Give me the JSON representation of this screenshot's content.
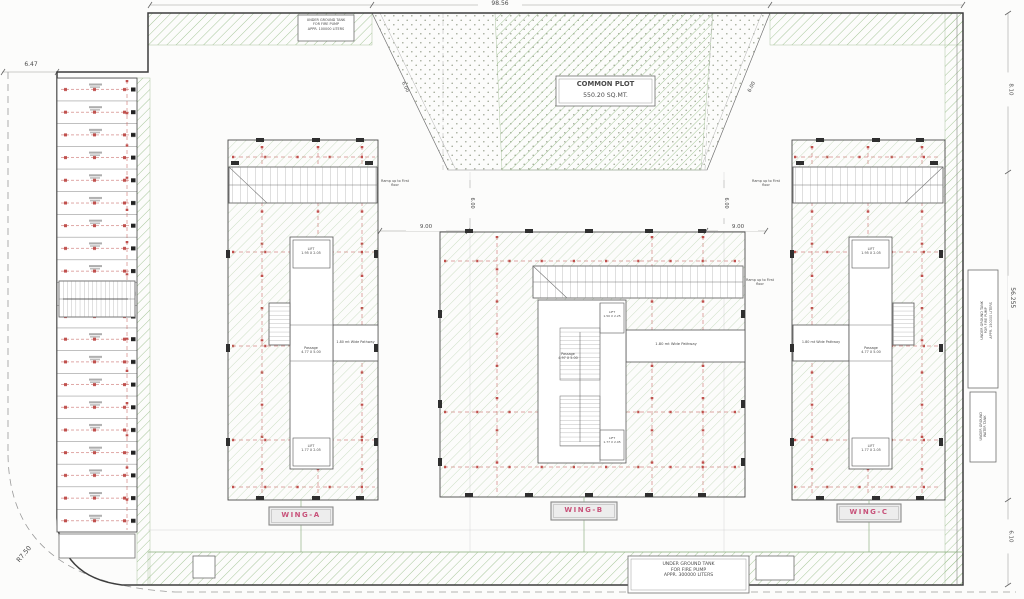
{
  "drawing": {
    "dims": {
      "plot_width": "98.56",
      "plot_height": "56.255",
      "offset_left": "6.47",
      "corner_radius": "R7.50",
      "nine": "9.00",
      "six": "6.00",
      "eight_ten": "8.10",
      "six_ten": "6.10"
    },
    "common_plot": {
      "name": "COMMON PLOT",
      "area": "550.20 SQ.MT."
    },
    "tanks": {
      "top_left": [
        "UNDER GROUND TANK",
        "FOR FIRE PUMP",
        "APPR. 100000 LITERS"
      ],
      "bottom": [
        "UNDER GROUND TANK",
        "FOR FIRE PUMP",
        "APPR. 300000 LITERS"
      ],
      "right": [
        "UNDER GROUND TANK",
        "FOR FIRE PUMP",
        "APPR. 150000 LITERS"
      ],
      "right2": [
        "UNDER GROUND",
        "WATER TANK"
      ]
    },
    "wings": {
      "a": "WING-A",
      "b": "WING-B",
      "c": "WING-C"
    },
    "labels": {
      "ramp": "Ramp up to First floor",
      "pathway": "1.80 mt Wide Pathway",
      "lift_top": "LIFT",
      "lift_top_size": "1.95 X 2.05",
      "lift_bottom": "LIFT",
      "lift_bottom_size": "1.77 X 2.05",
      "passage": "Passage",
      "passage_size": "4.77 X 5.00",
      "passage_b_size": "4.97 X 5.00",
      "lift_b": "LIFT",
      "lift_b_size": "1.50 X 2.25"
    },
    "parking": {
      "stall_count": 20
    },
    "colors": {
      "hatch": "#9dc18f",
      "grid_red": "#c0504d",
      "wing_label": "#c8527a"
    }
  }
}
